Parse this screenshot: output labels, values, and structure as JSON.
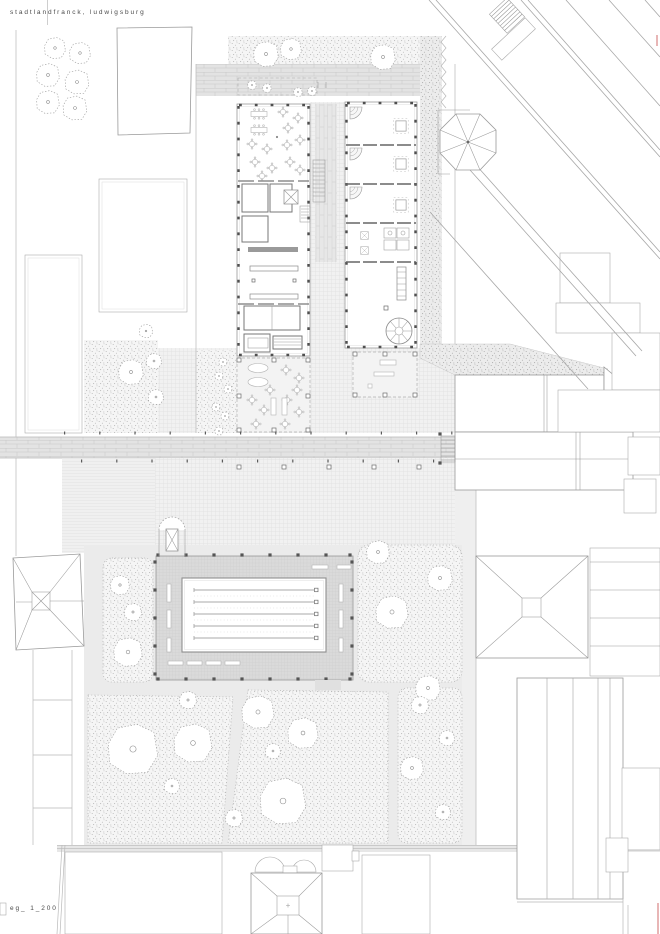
{
  "header": {
    "project_title": "stadtlandfranck, ludwigsburg"
  },
  "footer": {
    "drawing_label": "eg_ 1_200"
  },
  "plan": {
    "type": "architectural ground-floor site plan",
    "colors": {
      "line": "#9a9a9a",
      "plaza_paving": "#f1f1f1",
      "paver_band": "#e3e3e3",
      "pool_deck": "#dadada",
      "planting_stipple": "#f5f5f5",
      "canopy": "#f3f3f3",
      "accent_red": "#dc8f8f"
    }
  }
}
